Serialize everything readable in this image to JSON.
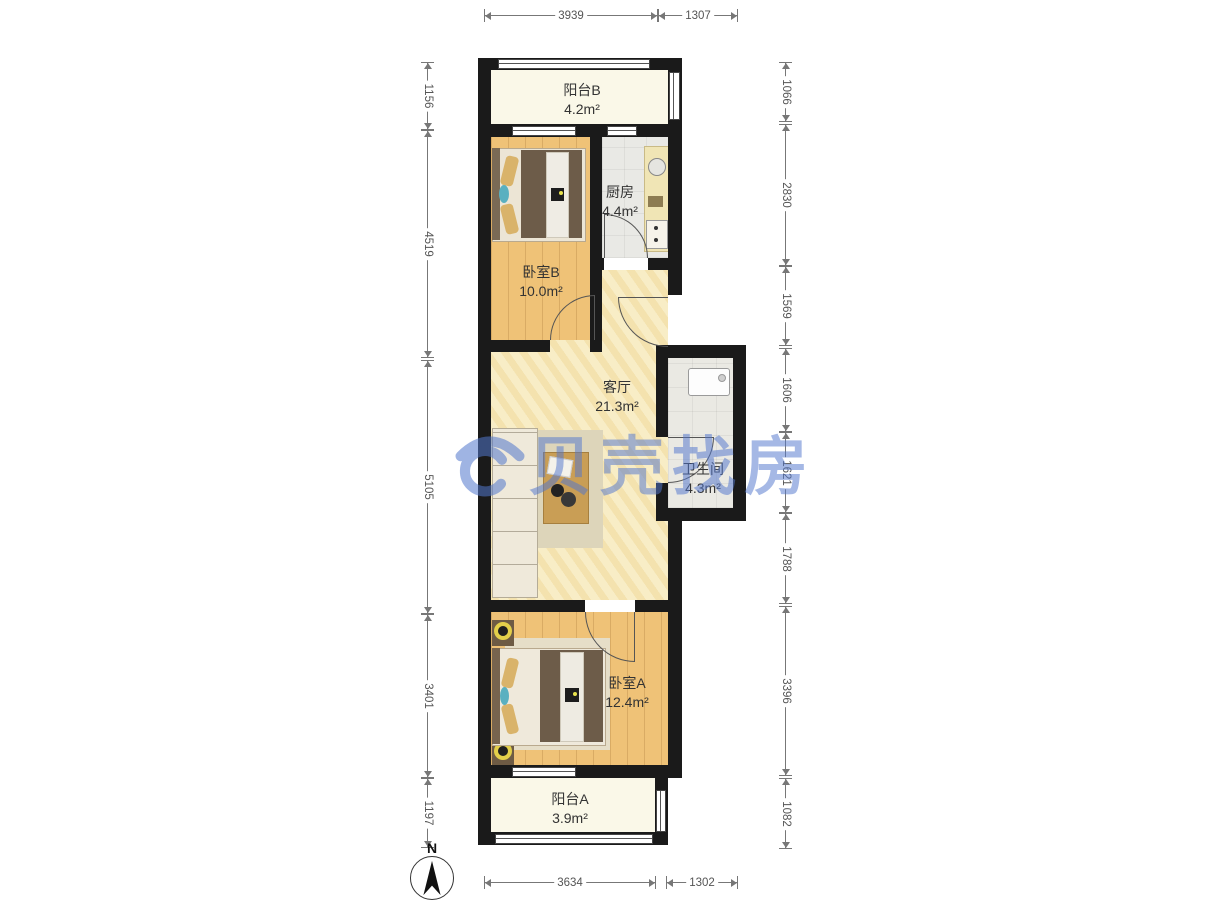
{
  "watermark": {
    "text": "贝壳找房",
    "color": "#5277cd"
  },
  "compass": {
    "label": "N"
  },
  "rooms": {
    "balcony_b": {
      "name": "阳台B",
      "area": "4.2m²"
    },
    "kitchen": {
      "name": "厨房",
      "area": "4.4m²"
    },
    "bedroom_b": {
      "name": "卧室B",
      "area": "10.0m²"
    },
    "living": {
      "name": "客厅",
      "area": "21.3m²"
    },
    "bathroom": {
      "name": "卫生间",
      "area": "4.3m²"
    },
    "bedroom_a": {
      "name": "卧室A",
      "area": "12.4m²"
    },
    "balcony_a": {
      "name": "阳台A",
      "area": "3.9m²"
    }
  },
  "dimensions": {
    "top": [
      "3939",
      "1307"
    ],
    "bottom": [
      "3634",
      "1302"
    ],
    "left": [
      "1156",
      "4519",
      "5105",
      "3401",
      "1197"
    ],
    "right": [
      "1066",
      "2830",
      "1569",
      "1606",
      "1621",
      "1788",
      "3396",
      "1082"
    ]
  },
  "colors": {
    "wall": "#1a1a1a",
    "wood_floor": "#efc277",
    "living_floor": "#f8edc6",
    "balcony_floor": "#faf8e8",
    "tile_floor": "#e9e9e5",
    "dimension_text": "#555555",
    "label_text": "#333333",
    "watermark_blue": "#5277cd"
  }
}
